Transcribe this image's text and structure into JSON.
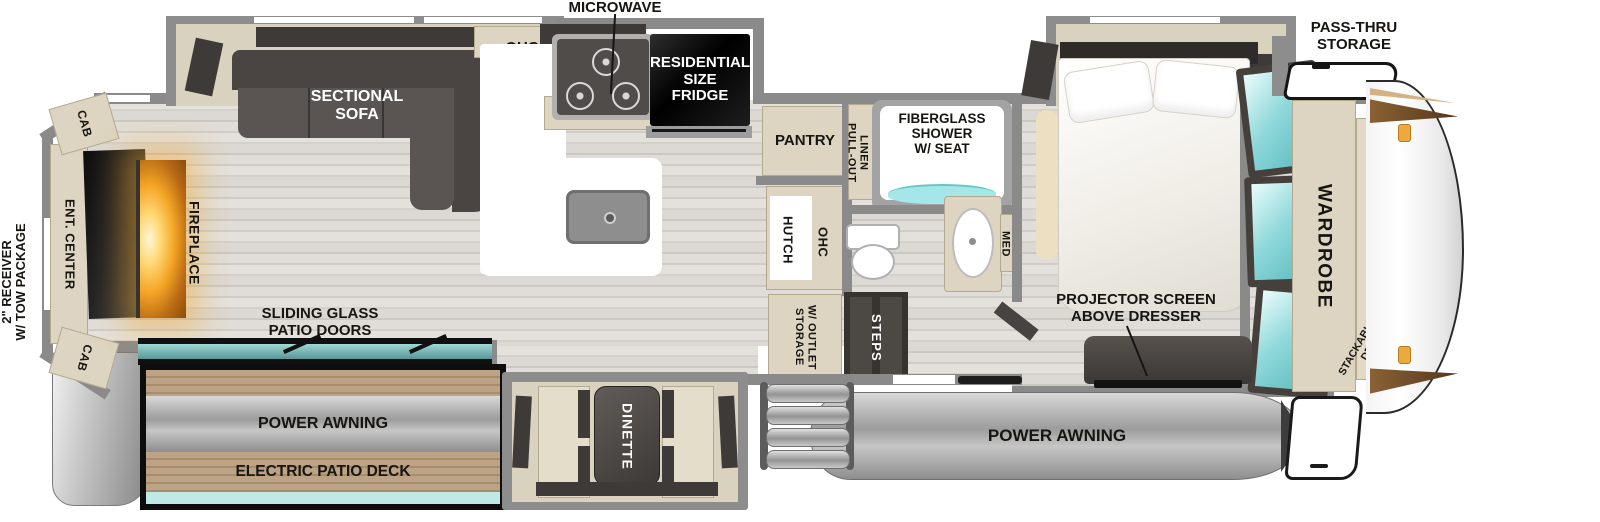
{
  "colors": {
    "wall_gray": "#8a8a8a",
    "cabinet_beige": "#ddd5c1",
    "dark_furniture": "#4a4542",
    "window_teal": "#8fd8da",
    "patio_glass_teal": "#4e8d90",
    "fireplace_orange": "#f4a626",
    "deck_wood": "#b59b78",
    "awning_gray": "#a9a9a9",
    "marker_amber": "#eba93f"
  },
  "exterior": {
    "receiver": "2\" RECEIVER\nW/ TOW PACKAGE",
    "pass_thru_storage": "PASS-THRU\nSTORAGE",
    "power_awning_rear": "POWER AWNING",
    "power_awning_front": "POWER AWNING",
    "electric_patio_deck": "ELECTRIC PATIO DECK",
    "sliding_glass_patio_doors": "SLIDING GLASS\nPATIO DOORS"
  },
  "living_room": {
    "sectional_sofa": "SECTIONAL\nSOFA",
    "fireplace": "FIREPLACE",
    "ent_center": "ENT. CENTER",
    "cab_upper": "CAB",
    "cab_lower": "CAB",
    "dinette": "DINETTE"
  },
  "kitchen": {
    "microwave": "MICROWAVE",
    "ohc": "OHC",
    "residential_fridge": "RESIDENTIAL\nSIZE\nFRIDGE",
    "pantry": "PANTRY",
    "hutch": "HUTCH",
    "hutch_ohc": "OHC"
  },
  "entry": {
    "storage_outlet": "STORAGE\nW/ OUTLET",
    "steps": "STEPS"
  },
  "bathroom": {
    "pull_out_linen": "PULL-OUT\nLINEN",
    "shower": "FIBERGLASS\nSHOWER\nW/ SEAT",
    "med": "MED"
  },
  "bedroom": {
    "projector_screen": "PROJECTOR SCREEN\nABOVE DRESSER",
    "wardrobe": "WARDROBE",
    "washer_dryer_prep": "STACKABLE WASHER/\nDRYER PREP"
  }
}
